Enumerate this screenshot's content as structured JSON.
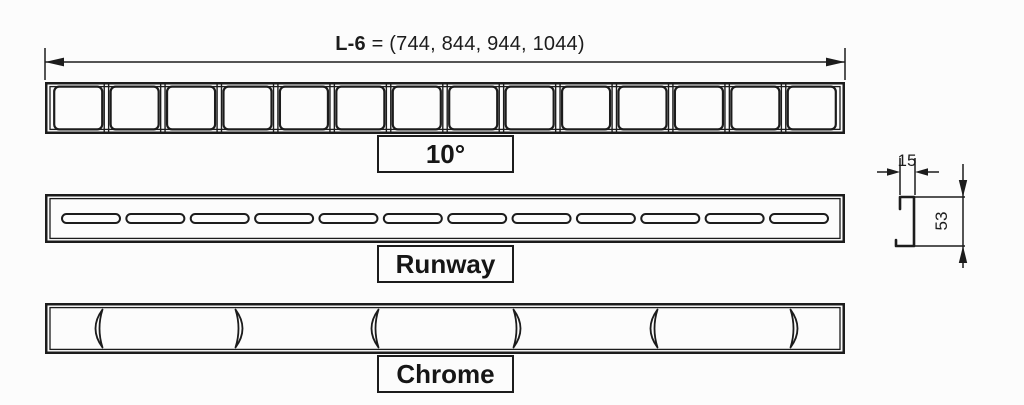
{
  "colors": {
    "line": "#1c1c1c",
    "background": "#fcfcfc"
  },
  "title_dimension": {
    "name": "L-6",
    "values": " = (744, 844, 944, 1044)"
  },
  "grates": [
    {
      "id": "10deg",
      "label": "10°",
      "pattern": "rounded-squares",
      "cell_count": 14
    },
    {
      "id": "runway",
      "label": "Runway",
      "pattern": "horizontal-slots",
      "slot_count": 12
    },
    {
      "id": "chrome",
      "label": "Chrome",
      "pattern": "curved-arcs",
      "arc_count": 6,
      "arc_sequence": [
        "(",
        ")",
        "(",
        ")",
        "(",
        ")"
      ]
    }
  ],
  "cross_section": {
    "width": "15",
    "height": "53"
  }
}
